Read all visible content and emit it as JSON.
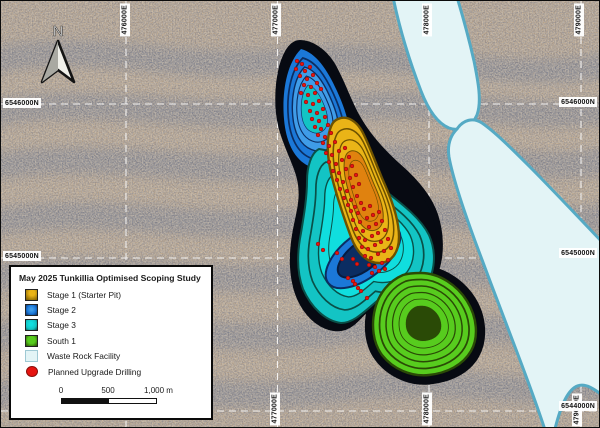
{
  "map": {
    "north_label": "N",
    "labels": {
      "top": [
        {
          "text": "476000E"
        },
        {
          "text": "477000E"
        },
        {
          "text": "478000E"
        },
        {
          "text": "479000E"
        }
      ],
      "bottom": [
        {
          "text": "477000E"
        },
        {
          "text": "478000E"
        },
        {
          "text": "479000E"
        }
      ],
      "left": [
        {
          "text": "6546000N"
        },
        {
          "text": "6545000N"
        }
      ],
      "right": [
        {
          "text": "6546000N"
        },
        {
          "text": "6545000N"
        },
        {
          "text": "6544000N"
        }
      ]
    },
    "drill_points": [
      [
        296,
        60
      ],
      [
        301,
        63
      ],
      [
        295,
        68
      ],
      [
        304,
        70
      ],
      [
        309,
        66
      ],
      [
        299,
        75
      ],
      [
        306,
        78
      ],
      [
        312,
        74
      ],
      [
        303,
        84
      ],
      [
        310,
        86
      ],
      [
        316,
        82
      ],
      [
        300,
        92
      ],
      [
        307,
        94
      ],
      [
        314,
        92
      ],
      [
        320,
        88
      ],
      [
        305,
        101
      ],
      [
        312,
        103
      ],
      [
        318,
        100
      ],
      [
        309,
        110
      ],
      [
        316,
        112
      ],
      [
        322,
        108
      ],
      [
        311,
        118
      ],
      [
        318,
        120
      ],
      [
        324,
        116
      ],
      [
        314,
        126
      ],
      [
        320,
        128
      ],
      [
        327,
        124
      ],
      [
        317,
        134
      ],
      [
        324,
        136
      ],
      [
        330,
        132
      ],
      [
        322,
        142
      ],
      [
        328,
        145
      ],
      [
        334,
        141
      ],
      [
        325,
        152
      ],
      [
        331,
        154
      ],
      [
        338,
        150
      ],
      [
        344,
        147
      ],
      [
        328,
        161
      ],
      [
        335,
        163
      ],
      [
        341,
        159
      ],
      [
        348,
        156
      ],
      [
        332,
        170
      ],
      [
        338,
        172
      ],
      [
        345,
        168
      ],
      [
        351,
        165
      ],
      [
        336,
        179
      ],
      [
        342,
        181
      ],
      [
        349,
        177
      ],
      [
        355,
        174
      ],
      [
        339,
        188
      ],
      [
        346,
        190
      ],
      [
        352,
        186
      ],
      [
        358,
        183
      ],
      [
        343,
        197
      ],
      [
        350,
        199
      ],
      [
        356,
        195
      ],
      [
        347,
        204
      ],
      [
        354,
        206
      ],
      [
        360,
        202
      ],
      [
        350,
        210
      ],
      [
        357,
        212
      ],
      [
        363,
        208
      ],
      [
        369,
        205
      ],
      [
        352,
        219
      ],
      [
        359,
        221
      ],
      [
        366,
        217
      ],
      [
        372,
        214
      ],
      [
        378,
        211
      ],
      [
        355,
        228
      ],
      [
        362,
        230
      ],
      [
        368,
        226
      ],
      [
        375,
        223
      ],
      [
        381,
        220
      ],
      [
        358,
        237
      ],
      [
        364,
        239
      ],
      [
        371,
        235
      ],
      [
        377,
        232
      ],
      [
        384,
        229
      ],
      [
        361,
        246
      ],
      [
        367,
        248
      ],
      [
        374,
        244
      ],
      [
        380,
        241
      ],
      [
        387,
        238
      ],
      [
        364,
        255
      ],
      [
        370,
        257
      ],
      [
        377,
        253
      ],
      [
        383,
        250
      ],
      [
        390,
        247
      ],
      [
        368,
        264
      ],
      [
        374,
        266
      ],
      [
        381,
        262
      ],
      [
        387,
        259
      ],
      [
        371,
        272
      ],
      [
        378,
        270
      ],
      [
        384,
        268
      ],
      [
        341,
        258
      ],
      [
        336,
        252
      ],
      [
        317,
        243
      ],
      [
        322,
        249
      ],
      [
        352,
        258
      ],
      [
        356,
        263
      ],
      [
        347,
        277
      ],
      [
        354,
        283
      ],
      [
        360,
        290
      ],
      [
        366,
        297
      ],
      [
        352,
        280
      ],
      [
        357,
        287
      ]
    ]
  },
  "legend": {
    "title": "May 2025 Tunkillia Optimised Scoping Study",
    "items": [
      {
        "label": "Stage 1 (Starter Pit)"
      },
      {
        "label": "Stage 2"
      },
      {
        "label": "Stage 3"
      },
      {
        "label": "South 1"
      },
      {
        "label": "Waste Rock Facility"
      },
      {
        "label": "Planned Upgrade Drilling"
      }
    ],
    "scalebar": {
      "label_0": "0",
      "label_500": "500",
      "label_1000": "1,000 m"
    }
  },
  "colors": {
    "stage1": {
      "bright": "#eab417",
      "dark": "#6e5200",
      "core": "#e0820f"
    },
    "stage2": {
      "bright": "#1b78d8",
      "dark": "#0b2d62",
      "core": "#3f9ce8"
    },
    "stage3": {
      "bright": "#13c4c4",
      "dark": "#0a5048",
      "core": "#10dede"
    },
    "south1": {
      "bright": "#57cc1e",
      "dark": "#2a4a06"
    },
    "wrf": {
      "fill": "#e3f4f6",
      "stroke": "#55aac4"
    },
    "drill": "#e61410",
    "pit_outline": "#070a12",
    "background": {
      "base": "#b1977a",
      "band": "#59647e",
      "ridge": "#cdb08a"
    }
  }
}
